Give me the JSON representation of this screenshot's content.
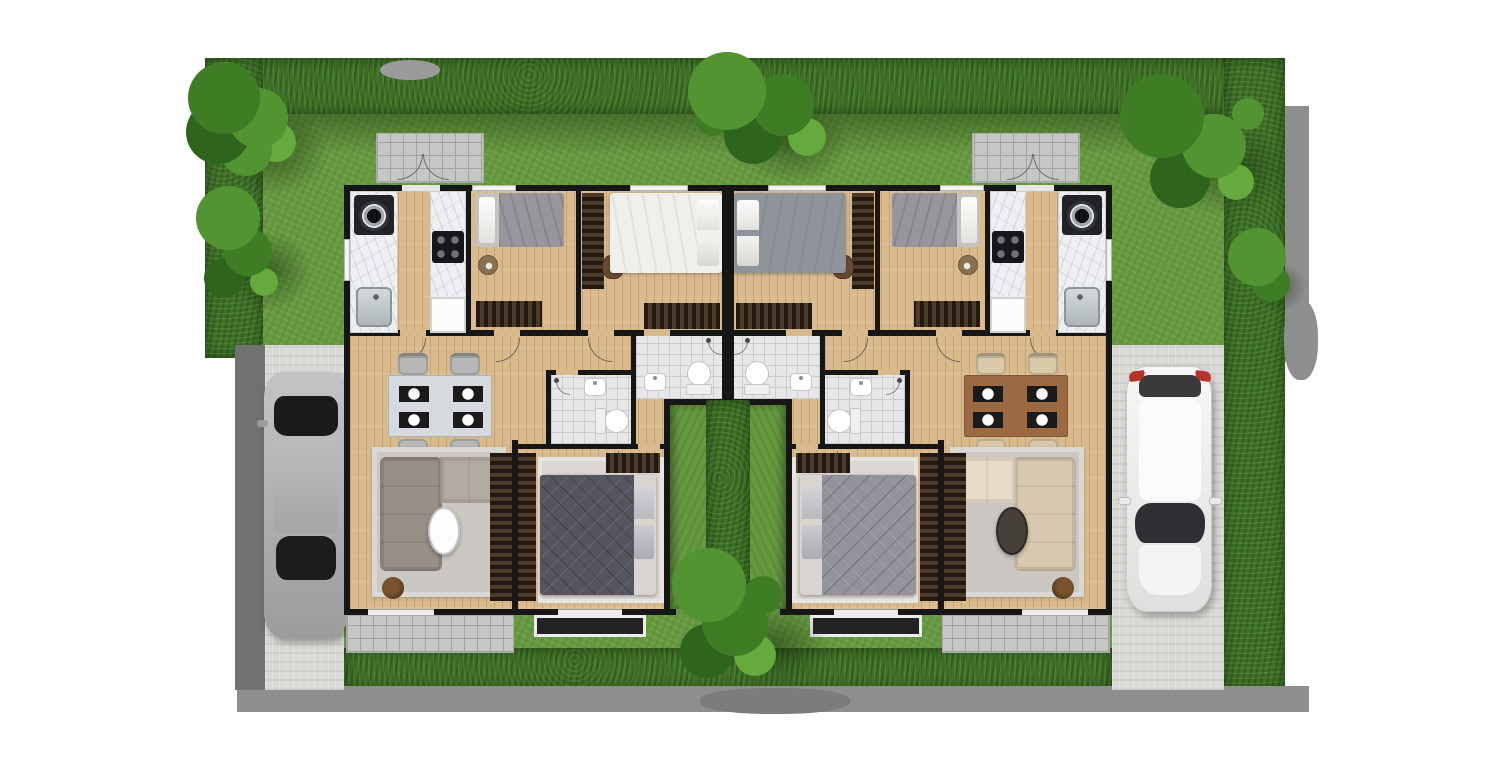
{
  "scene": {
    "title": "Twin-house duplex floor plan, top-down 3D render",
    "type": "architectural-floor-plan",
    "units": [
      {
        "side": "left",
        "vehicle": "silver sedan parked on driveway",
        "rooms": [
          "porch",
          "kitchen",
          "bedroom-1",
          "master-bedroom",
          "bathroom-1",
          "bathroom-2",
          "hallway",
          "dining-area",
          "living-room",
          "bedroom-2",
          "patio",
          "terrace",
          "courtyard"
        ],
        "furniture": [
          "washing-machine",
          "kitchen-sink",
          "gas-stove",
          "refrigerator",
          "single-bed",
          "side-table",
          "sideboard",
          "desk-wardrobe",
          "desk-chair",
          "double-bed-white",
          "dresser",
          "marble-dining-table",
          "dining-chairs-x4",
          "gray-l-shaped-sofa",
          "white-oval-coffee-table",
          "round-pouf",
          "tv-console",
          "area-rug",
          "double-bed-gray-tufted",
          "toilet-x2",
          "washbasin-x2",
          "shower-x2"
        ]
      },
      {
        "side": "right",
        "vehicle": "white hatchback parked on driveway",
        "rooms": [
          "porch",
          "kitchen",
          "bedroom-1",
          "master-bedroom",
          "bathroom-1",
          "bathroom-2",
          "hallway",
          "dining-area",
          "living-room",
          "bedroom-2",
          "patio",
          "terrace",
          "courtyard"
        ],
        "furniture": [
          "washing-machine",
          "kitchen-sink",
          "gas-stove",
          "refrigerator",
          "single-bed",
          "side-table",
          "sideboard",
          "desk-wardrobe",
          "desk-chair",
          "double-bed-gray",
          "dresser",
          "wooden-dining-table",
          "dining-chairs-x4",
          "cream-tufted-sofa",
          "dark-coffee-table",
          "round-pouf",
          "tv-console",
          "area-rug",
          "double-bed-light-gray",
          "toilet-x2",
          "washbasin-x2",
          "shower-x2"
        ]
      }
    ],
    "garden": [
      "perimeter-hedge",
      "lawn",
      "trees-x6",
      "courtyard-divider-hedge",
      "left-driveway",
      "right-driveway",
      "cast-shadows"
    ]
  },
  "palette": {
    "wall": "#161616",
    "wood": "#d9ba8c",
    "marble": "#edeff1",
    "tile": "#c6c6c6",
    "tile-line": "#a3a3a3",
    "bathtile": "#e7e7e9",
    "bathtile-line": "#cccccf",
    "grass": "#679a40",
    "hedge": "#3c7123",
    "tree1": "#2e641c",
    "tree2": "#3f7d24",
    "tree3": "#529431",
    "tree4": "#66a93f",
    "concrete": "#dbd9d5",
    "concrete-dark": "#717171",
    "shadow": "#8e8e8e",
    "sofa-gray": "#988f88",
    "sofa-gray-light": "#b3aaa2",
    "sofa-cream": "#d8c8b0",
    "sofa-cream-light": "#e7dcc8",
    "bed-white": "#f1efe9",
    "bed-gray": "#8f949b",
    "duvet-dark": "#55555f",
    "pillow": "#fafaf8",
    "rug": "#cbc7c2",
    "rug-light": "#dbd7d2",
    "darkwood-light": "#4c3a2b",
    "table-marble": "#d6d9dd",
    "table-wood": "#9c6a42",
    "chair-gray": "#b7b7b7",
    "chair-beige": "#d9c9a9",
    "steel": "#b9bec2",
    "taillight-red": "#b8322a",
    "terrace-dark": "#232326",
    "pouf-brown": "#7a5330"
  }
}
